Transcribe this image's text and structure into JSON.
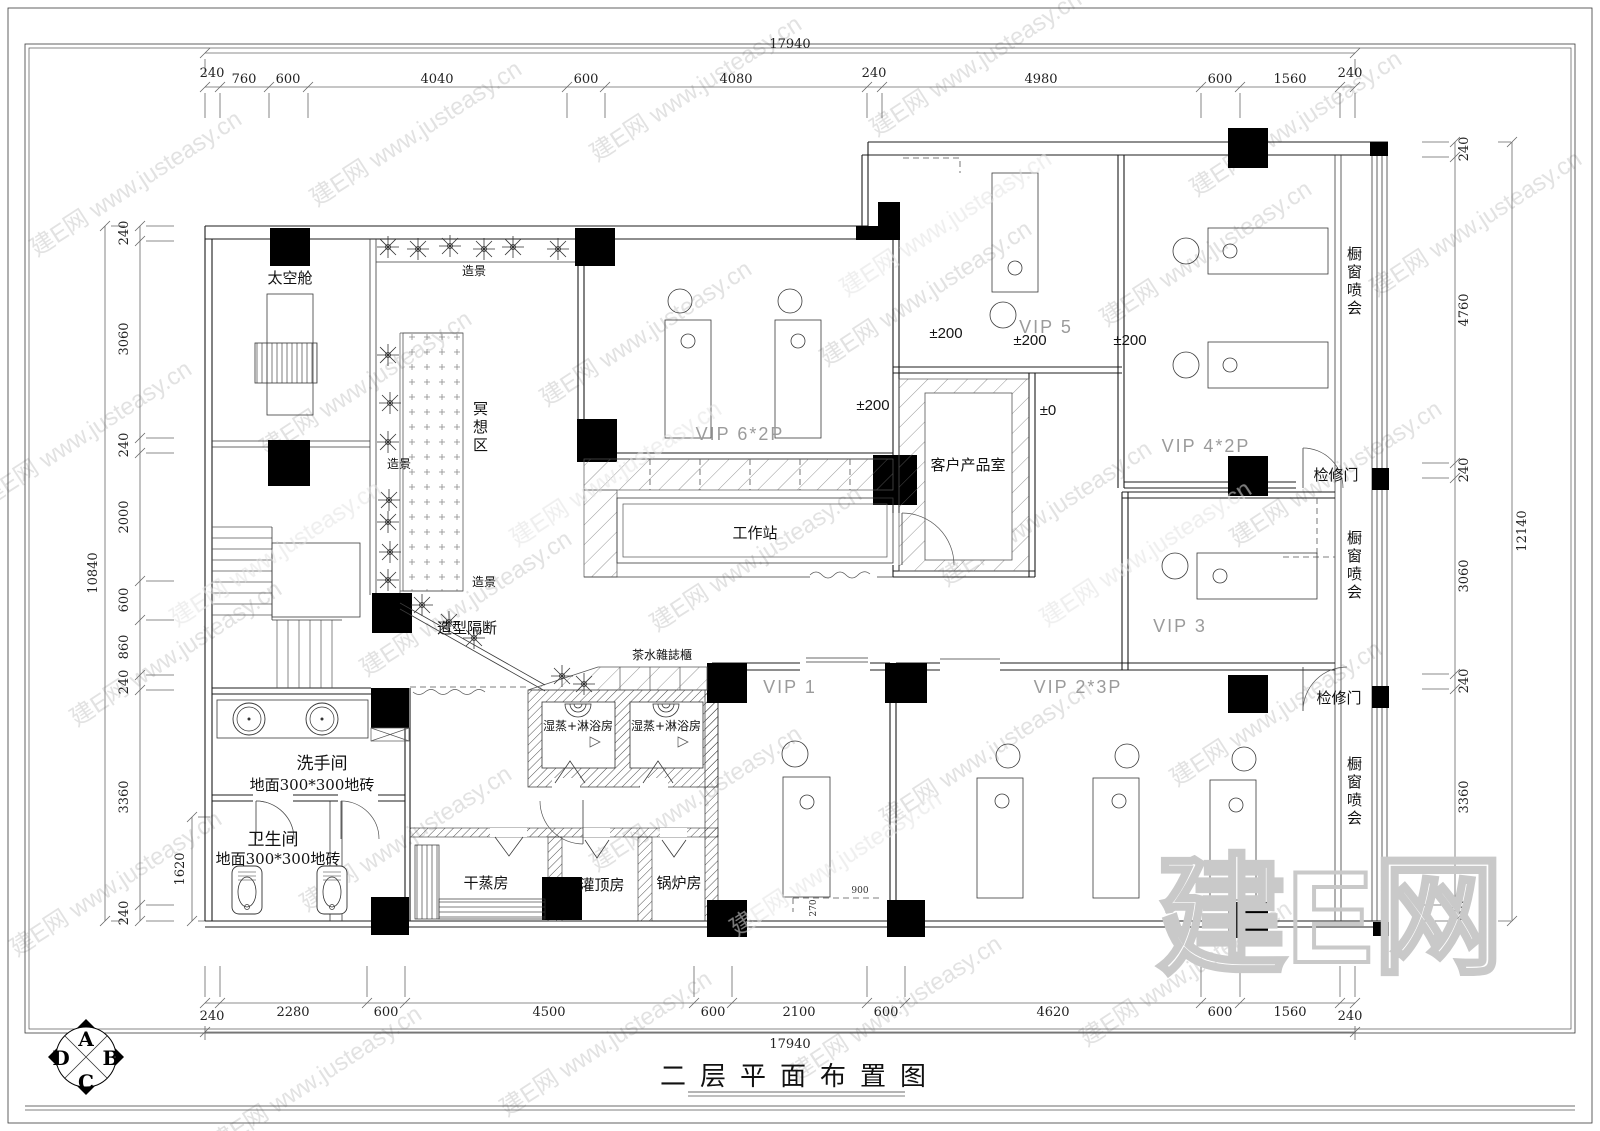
{
  "title": {
    "text": "二层平面布置图"
  },
  "compass": {
    "a": "A",
    "b": "B",
    "c": "C",
    "d": "D"
  },
  "watermark": {
    "tile": "建E网 www.justeasy.cn",
    "big": "建E网"
  },
  "dims": {
    "top": {
      "total": "17940",
      "segments": [
        "240",
        "760",
        "600",
        "4040",
        "600",
        "4080",
        "240",
        "4980",
        "600",
        "1560",
        "240"
      ]
    },
    "bottom": {
      "total": "17940",
      "segments": [
        "240",
        "2280",
        "600",
        "4500",
        "600",
        "2100",
        "600",
        "4620",
        "600",
        "1560",
        "240"
      ]
    },
    "left": {
      "total": "10840",
      "segments": [
        "240",
        "3060",
        "240",
        "2000",
        "600",
        "860",
        "240",
        "3360",
        "240"
      ],
      "inner": "1620"
    },
    "right": {
      "total": "12140",
      "segments": [
        "240",
        "4760",
        "240",
        "3060",
        "240",
        "3360",
        "240"
      ]
    }
  },
  "rooms": {
    "space_capsule": "太空舱",
    "scenery_top": "造景",
    "scenery_mid": "造景",
    "scenery_bottom": "造景",
    "meditation": "冥想区",
    "partition": "造型隔断",
    "tea_cabinet": "茶水雜誌櫃",
    "steam_shower": "湿蒸+淋浴房",
    "vip6": "VIP 6*2P",
    "workstation": "工作站",
    "product_room": "客户产品室",
    "vip5": "VIP 5",
    "vip4": "VIP 4*2P",
    "vip3": "VIP 3",
    "vip1": "VIP 1",
    "vip2": "VIP 2*3P",
    "window_display": "橱窗喷会",
    "access_door": "检修门",
    "washroom": "洗手间",
    "washroom_floor": "地面300*300地砖",
    "toilet": "卫生间",
    "toilet_floor": "地面300*300地砖",
    "dry_steam": "干蒸房",
    "guanding": "灌顶房",
    "boiler": "锅炉房"
  },
  "levels": {
    "l200": "±200",
    "l0": "±0"
  },
  "small_dims": {
    "d900": "900",
    "d270": "270"
  }
}
